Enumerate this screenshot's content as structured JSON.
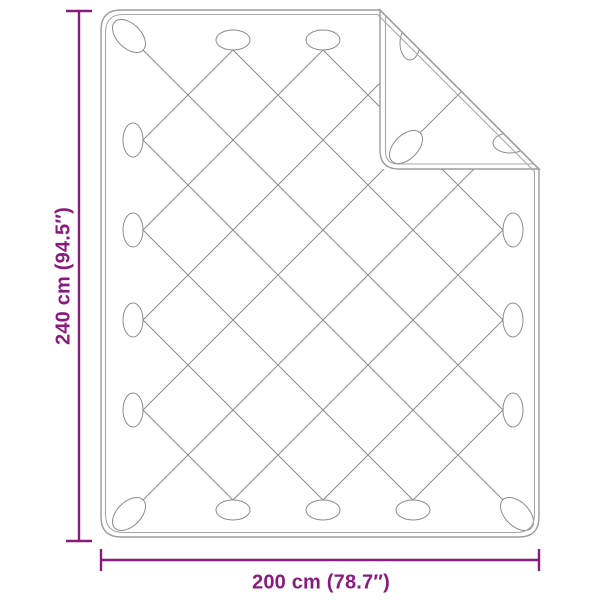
{
  "diagram": {
    "type": "product-dimension-diagram",
    "subject": "quilted blanket with folded corner",
    "height_dimension": "240 cm (94.5″)",
    "width_dimension": "200 cm (78.7″)"
  },
  "style": {
    "dimension_color": "#8a1b7e",
    "outline_color": "#9b9b9b",
    "inner_seam_color": "#a8a8a8",
    "pattern_line_color": "#8c8c8c",
    "background": "#ffffff"
  }
}
